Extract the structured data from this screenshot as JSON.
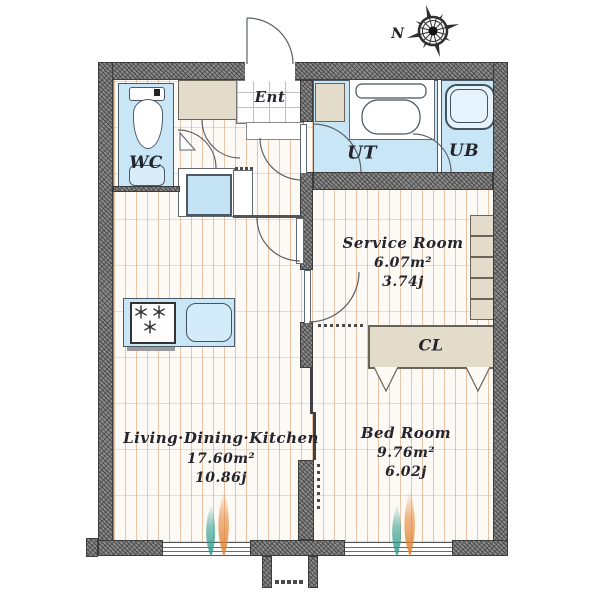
{
  "compass": {
    "label": "N"
  },
  "rooms": {
    "wc": {
      "label": "WC"
    },
    "ent": {
      "label": "Ent"
    },
    "ut": {
      "label": "UT"
    },
    "ub": {
      "label": "UB"
    },
    "cl": {
      "label": "CL"
    },
    "service": {
      "name": "Service Room",
      "area": "6.07m²",
      "tatami": "3.74j"
    },
    "bed": {
      "name": "Bed Room",
      "area": "9.76m²",
      "tatami": "6.02j"
    },
    "ldk": {
      "name": "Living·Dining·Kitchen",
      "area": "17.60m²",
      "tatami": "10.86j"
    }
  },
  "colors": {
    "wall": "#8c8c8c",
    "wet": "#c9e6f6",
    "cabinet": "#e4dcca",
    "floor_line": "#d69664",
    "text": "#24242c",
    "leaf_teal": "#2e9c8c",
    "leaf_orange": "#e2822f"
  }
}
